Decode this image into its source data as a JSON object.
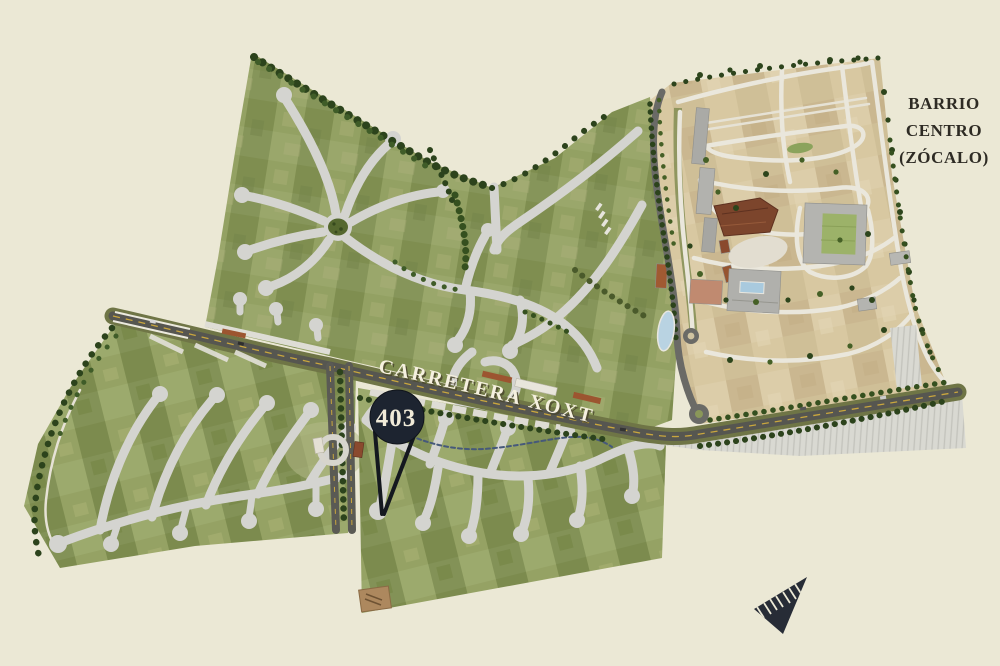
{
  "map": {
    "background": "#ebe8d5",
    "district_label": {
      "lines": [
        "BARRIO",
        "CENTRO",
        "(ZÓCALO)"
      ]
    },
    "road_label": {
      "text": "CARRETERA XOXTLA"
    },
    "marker": {
      "lot_number": "403"
    },
    "icons": {
      "compass": "north-arrow",
      "marker": "location-pin"
    },
    "colors": {
      "parcel_green": "#8a9759",
      "parcel_tan": "#d3c39c",
      "street_gray": "#d4d4d0",
      "highway_asphalt": "#565650",
      "highway_verge": "#6f7546",
      "lane_dash_yellow": "#c9a63e",
      "tree_dark_green": "#2c431c",
      "pond_blue": "#b9d3e2",
      "marker_fill": "#1d2430",
      "marker_text": "#f0ead8",
      "road_label_fill": "#f5f0df",
      "district_label_color": "#2e2b24",
      "compass_fill": "#272c36"
    }
  }
}
